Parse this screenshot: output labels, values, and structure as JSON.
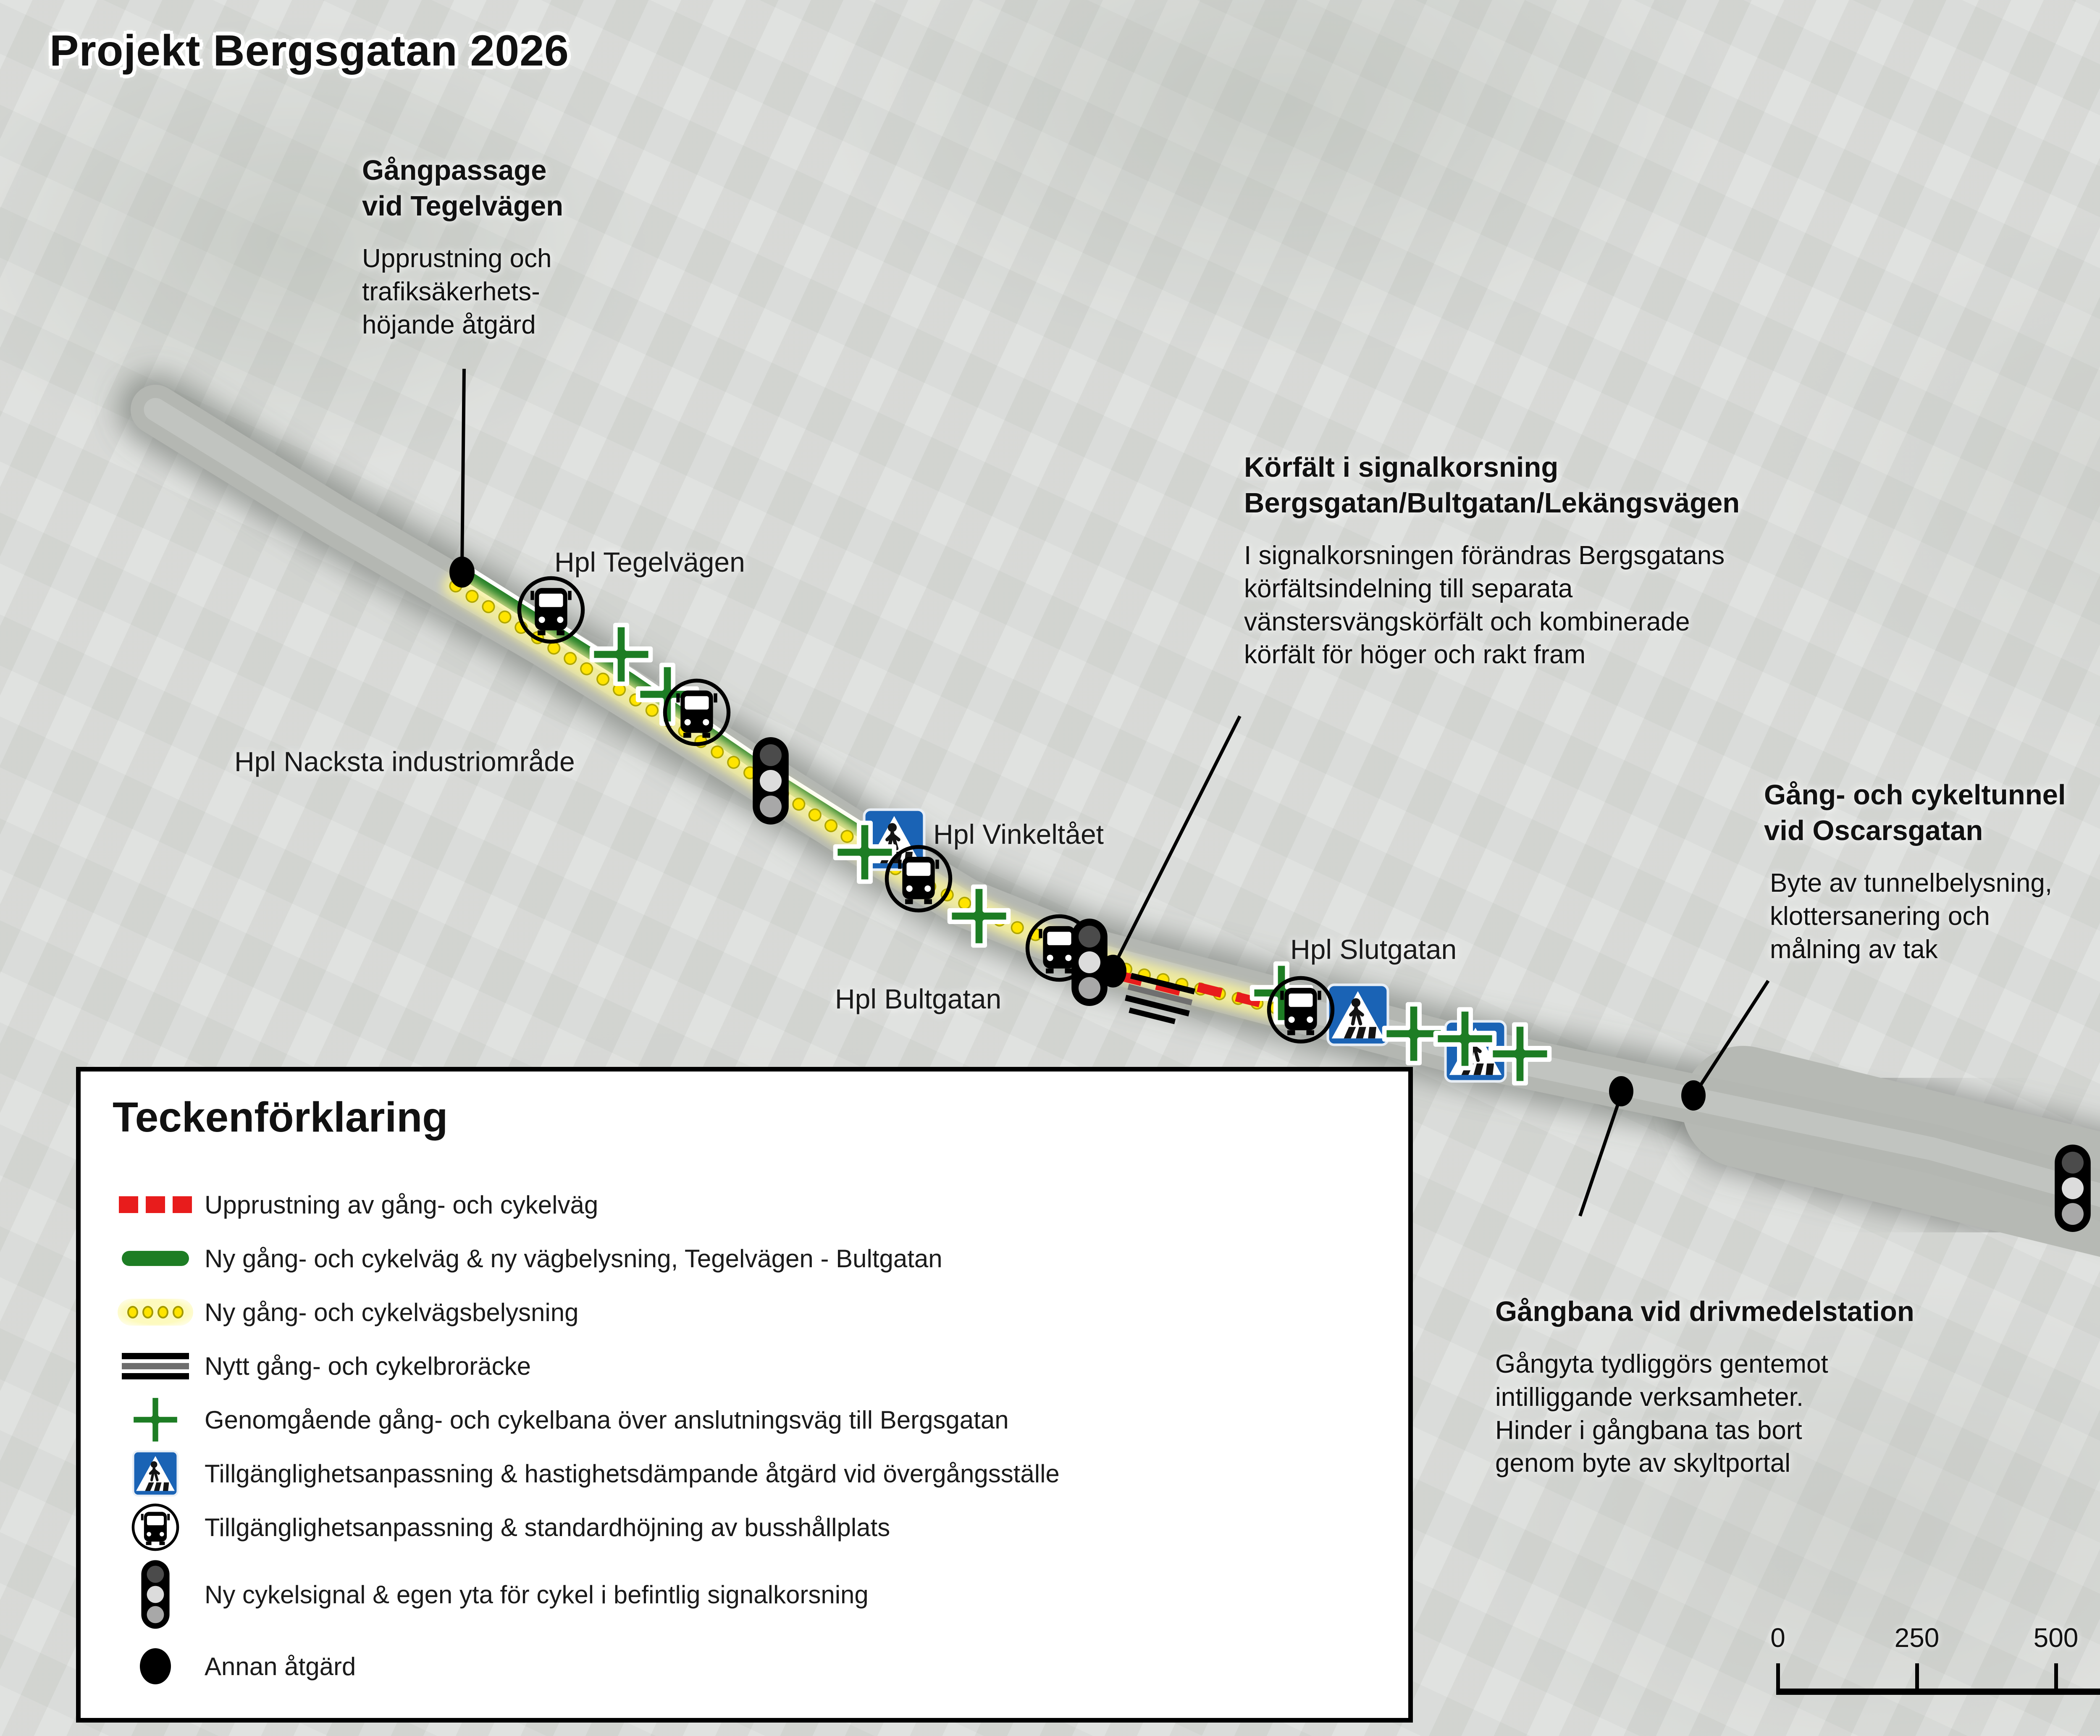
{
  "title": "Projekt Bergsgatan 2026",
  "annotations": {
    "gangpassage": {
      "heading": "Gångpassage\nvid Tegelvägen",
      "body": "Upprustning och\ntrafiksäkerhets-\nhöjande åtgärd"
    },
    "korfalt": {
      "heading": "Körfält i signalkorsning\nBergsgatan/Bultgatan/Lekängsvägen",
      "body": "I signalkorsningen förändras Bergsgatans\nkörfältsindelning till separata\nvänstersvängskörfält och kombinerade\nkörfält för höger och rakt fram"
    },
    "tunnel": {
      "heading": "Gång- och cykeltunnel\nvid Oscarsgatan",
      "body": "Byte av tunnelbelysning,\nklottersanering och\nmålning av tak"
    },
    "gangbana": {
      "heading": "Gångbana vid drivmedelstation",
      "body": "Gångyta tydliggörs gentemot\nintilliggande verksamheter.\nHinder i gångbana tas bort\ngenom byte av skyltportal"
    }
  },
  "map_labels": {
    "tegelvagen": "Hpl Tegelvägen",
    "nacksta": "Hpl Nacksta industriområde",
    "vinkeltaet": "Hpl Vinkeltået",
    "bultgatan": "Hpl Bultgatan",
    "slutgatan": "Hpl Slutgatan"
  },
  "legend": {
    "title": "Teckenförklaring",
    "items": [
      {
        "symbol": "red-dashed-line",
        "label": "Upprustning av gång- och cykelväg"
      },
      {
        "symbol": "green-line",
        "label": "Ny  gång- och cykelväg & ny vägbelysning, Tegelvägen - Bultgatan"
      },
      {
        "symbol": "yellow-dots",
        "label": "Ny gång- och cykelvägsbelysning"
      },
      {
        "symbol": "railing-lines",
        "label": "Nytt gång- och cykelbroräcke"
      },
      {
        "symbol": "green-cross",
        "label": "Genomgående gång- och cykelbana över anslutningsväg till Bergsgatan"
      },
      {
        "symbol": "crosswalk-sign",
        "label": "Tillgänglighetsanpassning & hastighetsdämpande åtgärd vid övergångsställe"
      },
      {
        "symbol": "bus-icon",
        "label": "Tillgänglighetsanpassning & standardhöjning av busshållplats"
      },
      {
        "symbol": "traffic-signal-icon",
        "label": "Ny cykelsignal & egen yta för cykel i befintlig signalkorsning"
      },
      {
        "symbol": "black-dot",
        "label": "Annan åtgärd"
      }
    ]
  },
  "scale_bar": {
    "labels": [
      "0",
      "250",
      "500",
      "750",
      "1 000 m"
    ]
  },
  "colors": {
    "accent_green": "#1d7d24",
    "warning_red": "#e81c1c",
    "lighting_yellow": "#ffe400",
    "sign_blue": "#1a63b5"
  }
}
